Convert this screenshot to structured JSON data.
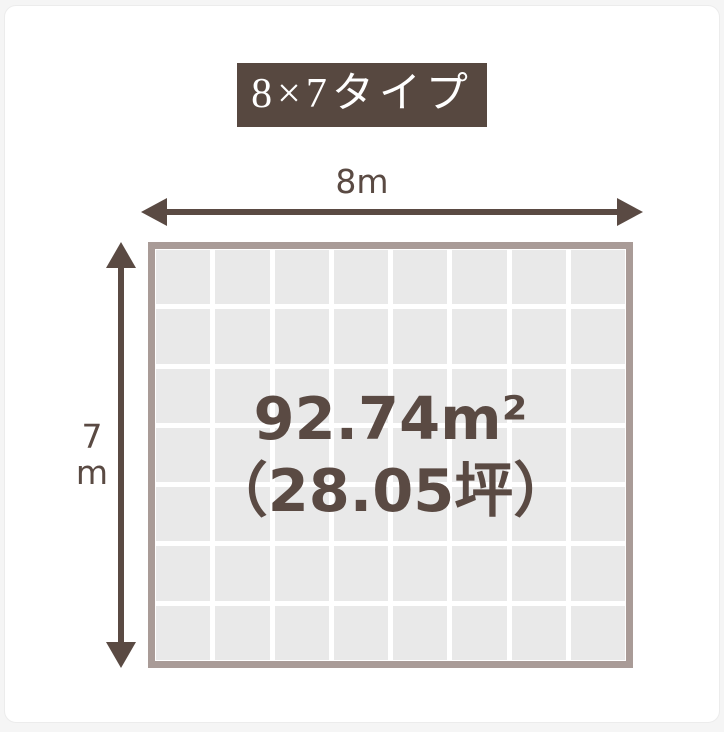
{
  "title_badge": {
    "label": "8×7タイプ",
    "bg_color": "#574840",
    "text_color": "#ffffff"
  },
  "dimensions": {
    "width_label": "8m",
    "height_label": "7m",
    "height_label_chars": [
      "7",
      "m"
    ]
  },
  "area": {
    "line1": "92.74m²",
    "line2": "（28.05坪）"
  },
  "grid": {
    "columns": 8,
    "rows": 7,
    "cell_color": "#e9e9e9",
    "frame_color": "#a99b97"
  },
  "colors": {
    "accent_brown": "#5a4a43",
    "card_bg": "#ffffff",
    "page_bg": "#f5f5f5"
  }
}
